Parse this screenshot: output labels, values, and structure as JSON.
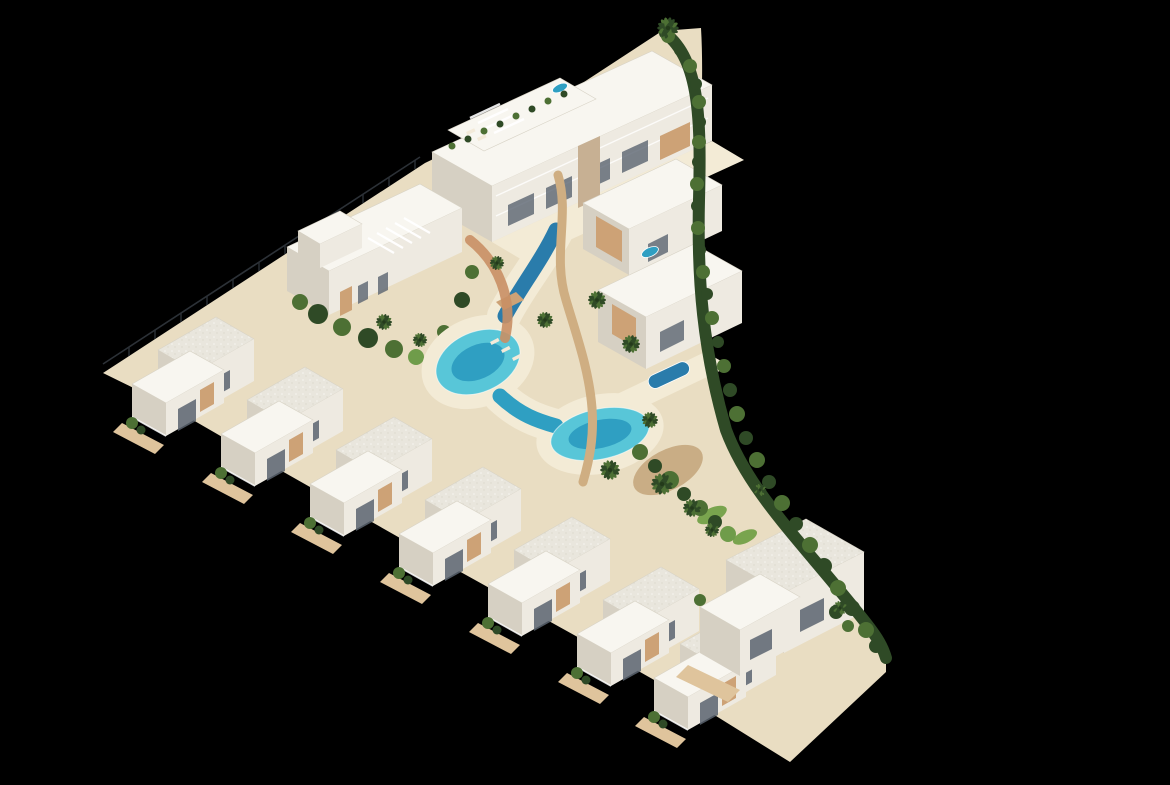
{
  "meta": {
    "title": "Aerial 3D render of a triangular coastal residential development at night-black backdrop",
    "view": "isometric aerial",
    "background": "#000000"
  },
  "colors": {
    "background": "#000000",
    "wall_light": "#f8f6f0",
    "wall_mid": "#eeeae1",
    "wall_shadow": "#d6d0c3",
    "wall_deep": "#c3bcac",
    "roof_base": "#e9e6dd",
    "roof_dot": "#f7f6f1",
    "sand": "#e9ddc2",
    "sand_light": "#f3ebd6",
    "deck": "#cda276",
    "deck_light": "#dfc49c",
    "path": "#cfae82",
    "tile": "#c98f65",
    "dirt": "#c9ad85",
    "pool_light": "#58c6d8",
    "pool_mid": "#2f9fc2",
    "pool_deep": "#2a7cab",
    "green_dark": "#2f4a26",
    "green_mid": "#4d7034",
    "green_light": "#6f9c4a",
    "lawn": "#79a44e",
    "fence": "#2c3137",
    "window": "#5a6470",
    "stone": "#c7b093",
    "lounger": "#f3ead9"
  },
  "scene": {
    "site_shape": "triangular wedge plot, left tip pointing west, curved hedge boundary on the east, stepped villa row along the south edge",
    "elements": {
      "apartment_block_top": "three-storey apartment block with roof terraces, pergolas, jacuzzi and planters",
      "pergola_building": "low-rise building with angled white pergola fins, middle-left",
      "terraced_houses_right": "two stepped terraced houses east of the lagoon with timber screens and a private plunge pool",
      "villa_row_bottom": "row of detached two-storey villas with speckled roofs, white roof terraces, timber decks and shrubs",
      "corner_villa": "larger villa cluster at the south-east corner",
      "lagoon_pool": "winding lagoon-style communal pool with deep-blue upper channel, two turquoise lagoons and sandy beach edges",
      "boardwalk": "timber boardwalk weaving along the east side of the lagoon",
      "footbridge": "small timber footbridge crossing the pool channel",
      "perimeter_fence": "thin dark post fence along the straight upper-left boundary",
      "perimeter_hedge": "dense green hedge following the curved right boundary",
      "palm_garden": "palm trees and tropical planting with dirt paths and lawn patches, south-east of the lagoon",
      "sun_loungers": "cream sun loungers on the pool beach and roof terraces"
    },
    "counts": {
      "bottom_row_villas": 8,
      "apartment_blocks": 2,
      "terraced_houses": 2,
      "palm_trees": 14,
      "plunge_pools": 3
    }
  }
}
